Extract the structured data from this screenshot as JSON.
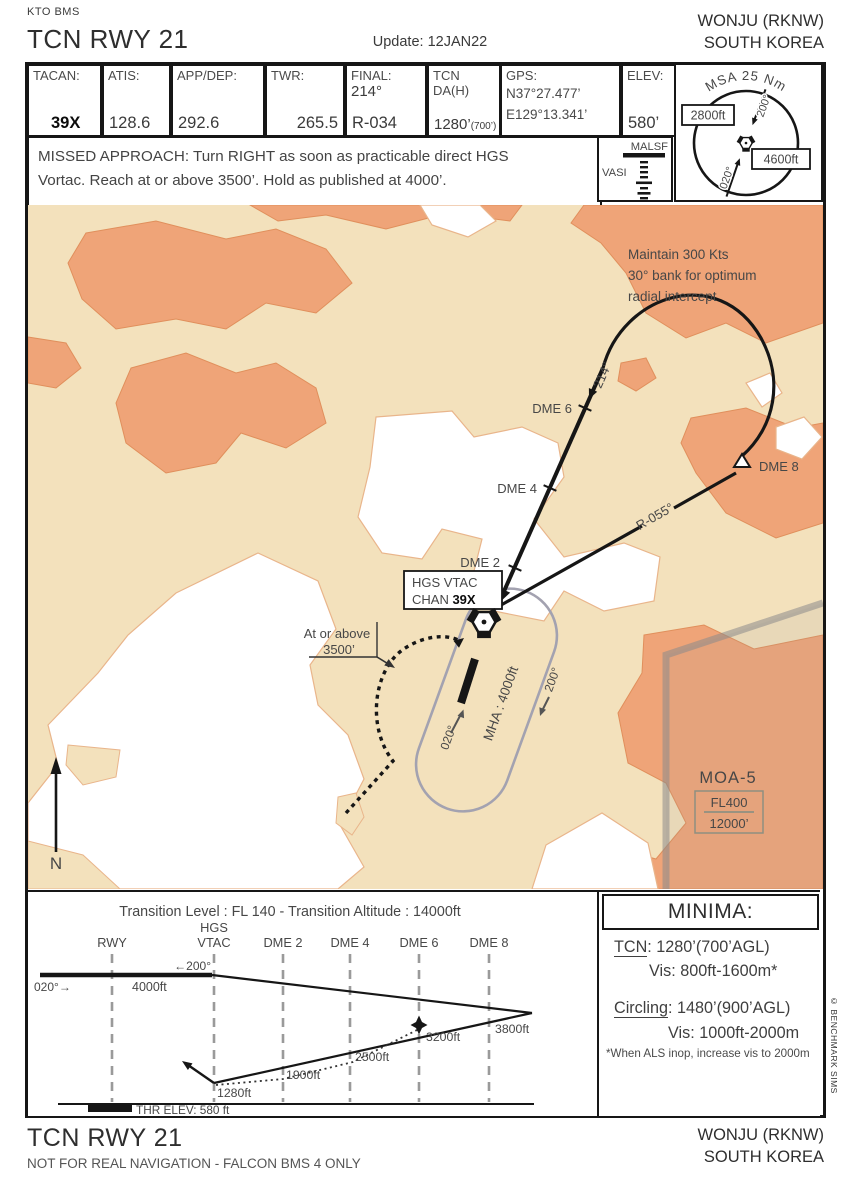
{
  "colors": {
    "ink": "#161616",
    "text_gray": "#474747",
    "terrain_tan": "#f3e1bc",
    "terrain_orange": "#efa478",
    "hold_gray": "#a3a2b0",
    "moa_gray": "#8f8f80"
  },
  "location": {
    "line1": "WONJU (RKNW)",
    "line2": "SOUTH KOREA"
  },
  "header": {
    "org": "KTO BMS",
    "title": "TCN RWY 21",
    "update": "Update: 12JAN22"
  },
  "strip": {
    "tacan_label": "TACAN:",
    "tacan_value": "39X",
    "atis_label": "ATIS:",
    "atis_value": "128.6",
    "appdep_label": "APP/DEP:",
    "appdep_value": "292.6",
    "twr_label": "TWR:",
    "twr_value": "265.5",
    "final_label": "FINAL:",
    "final_course": "214°",
    "final_value": "R-034",
    "da_label": "TCN DA(H)",
    "da_value": "1280’",
    "da_value_small": "(700’)",
    "gps_label": "GPS:",
    "gps_lat": "N37°27.477’",
    "gps_lon": "E129°13.341’",
    "elev_label": "ELEV:",
    "elev_value": "580’"
  },
  "missed_approach": {
    "line1": "MISSED APPROACH: Turn RIGHT as soon as practicable direct HGS",
    "line2": "Vortac. Reach at or above 3500’. Hold as published at 4000’."
  },
  "lighting": {
    "malsf": "MALSF",
    "vasi": "VASI"
  },
  "msa": {
    "title": "MSA 25 Nm",
    "west_alt": "2800ft",
    "east_alt": "4600ft",
    "radial_north": "200°",
    "radial_south": "020°"
  },
  "map": {
    "note_line1": "Maintain 300 Kts",
    "note_line2": "30° bank for optimum",
    "note_line3": "radial intercept",
    "course_label": "214°",
    "dme2": "DME 2",
    "dme4": "DME 4",
    "dme6": "DME 6",
    "dme8": "DME 8",
    "radial_label": "R-055°",
    "navaid_line1": "HGS VTAC",
    "navaid_chan": "CHAN ",
    "navaid_chan_value": "39X",
    "hold_mha": "MHA : 4000ft",
    "hold_inbound": "020°",
    "hold_outbound": "200°",
    "note_alt_line1": "At or above",
    "note_alt_line2": "3500’",
    "moa_name": "MOA-5",
    "moa_upper": "FL400",
    "moa_lower": "12000’",
    "north": "N"
  },
  "profile": {
    "transition": "Transition Level : FL 140  -  Transition Altitude : 14000ft",
    "col_rwy": "RWY",
    "col_hgs1": "HGS",
    "col_hgs2": "VTAC",
    "col_dme2": "DME 2",
    "col_dme4": "DME 4",
    "col_dme6": "DME 6",
    "col_dme8": "DME 8",
    "outbound": "←200°",
    "inbound": "020°→",
    "alt_4000": "4000ft",
    "alt_3800": "3800ft",
    "alt_3200": "3200ft",
    "alt_2500": "2500ft",
    "alt_1900": "1900ft",
    "alt_1280": "1280ft",
    "thr_elev": "THR ELEV: 580 ft"
  },
  "minima": {
    "title": "MINIMA:",
    "tcn_label": "TCN",
    "tcn_rest": ": 1280’(700’AGL)",
    "tcn_vis": "Vis: 800ft-1600m*",
    "circling_label": "Circling",
    "circling_rest": ": 1480’(900’AGL)",
    "circling_vis": "Vis: 1000ft-2000m",
    "note": "*When ALS inop, increase vis to 2000m"
  },
  "footer": {
    "title": "TCN RWY 21",
    "disclaimer": "NOT FOR REAL NAVIGATION - FALCON  BMS 4 ONLY"
  },
  "copyright": "© BENCHMARK SIMS"
}
